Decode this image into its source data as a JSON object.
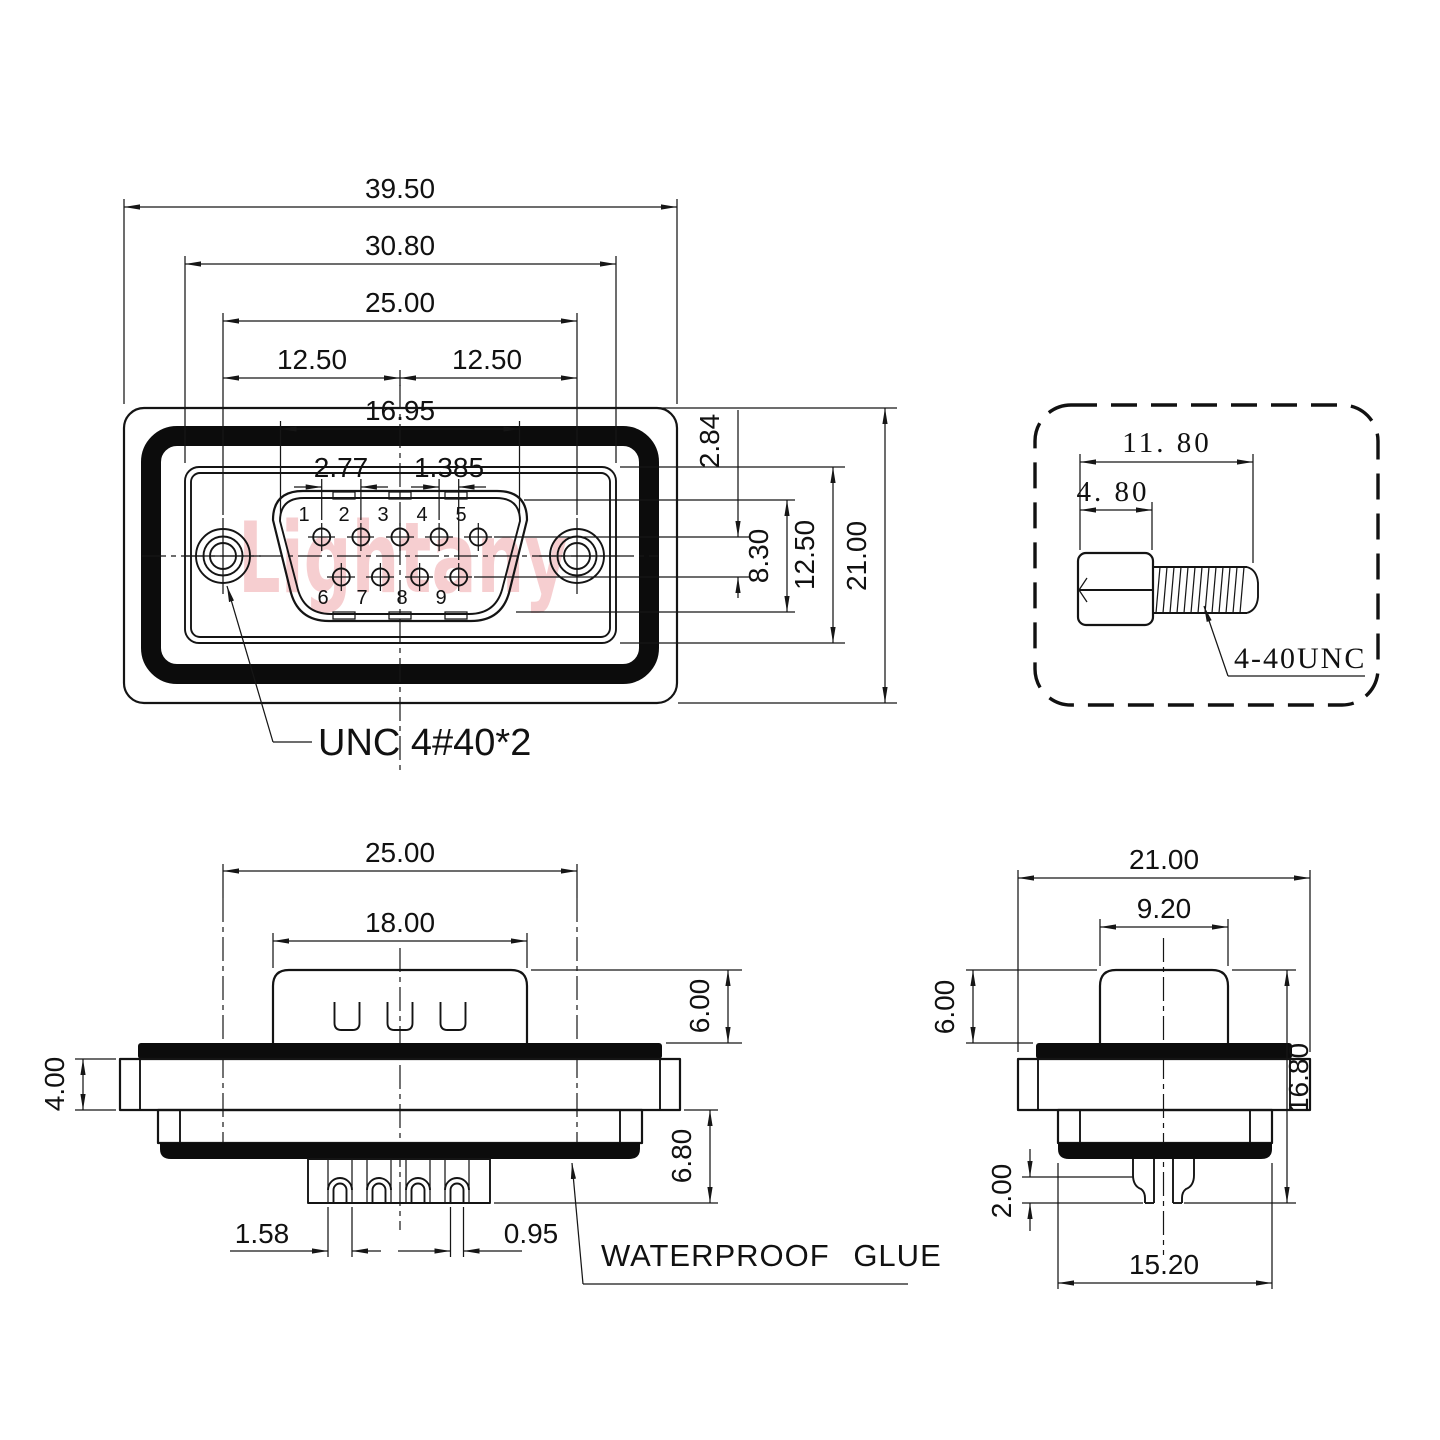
{
  "watermark": "Lightany",
  "front": {
    "w_total": "39.50",
    "w_inner": "30.80",
    "w_holes": "25.00",
    "w_half_left": "12.50",
    "w_half_right": "12.50",
    "w_shell": "16.95",
    "pin_pitch": "2.77",
    "row_offset": "1.385",
    "row_gap": "2.84",
    "h_shell": "8.30",
    "h_inner": "12.50",
    "h_total": "21.00",
    "pins_top": [
      "1",
      "2",
      "3",
      "4",
      "5"
    ],
    "pins_bottom": [
      "6",
      "7",
      "8",
      "9"
    ],
    "thread_note": "UNC 4#40*2"
  },
  "screw": {
    "len_total": "11. 80",
    "len_head": "4. 80",
    "thread_spec": "4-40UNC"
  },
  "side": {
    "w_holes": "25.00",
    "w_shell": "18.00",
    "h_shell": "6.00",
    "h_flange": "4.00",
    "h_lower": "6.80",
    "pin_outer": "1.58",
    "pin_inner": "0.95",
    "glue_note": "WATERPROOF GLUE"
  },
  "profile": {
    "w_flange": "21.00",
    "w_shell": "9.20",
    "h_shell": "6.00",
    "h_total": "16.80",
    "pin_step": "2.00",
    "w_body": "15.20"
  },
  "colors": {
    "line": "#141414",
    "glue": "#0c0c0c",
    "watermark": "#f5c2c5",
    "background": "#ffffff"
  }
}
